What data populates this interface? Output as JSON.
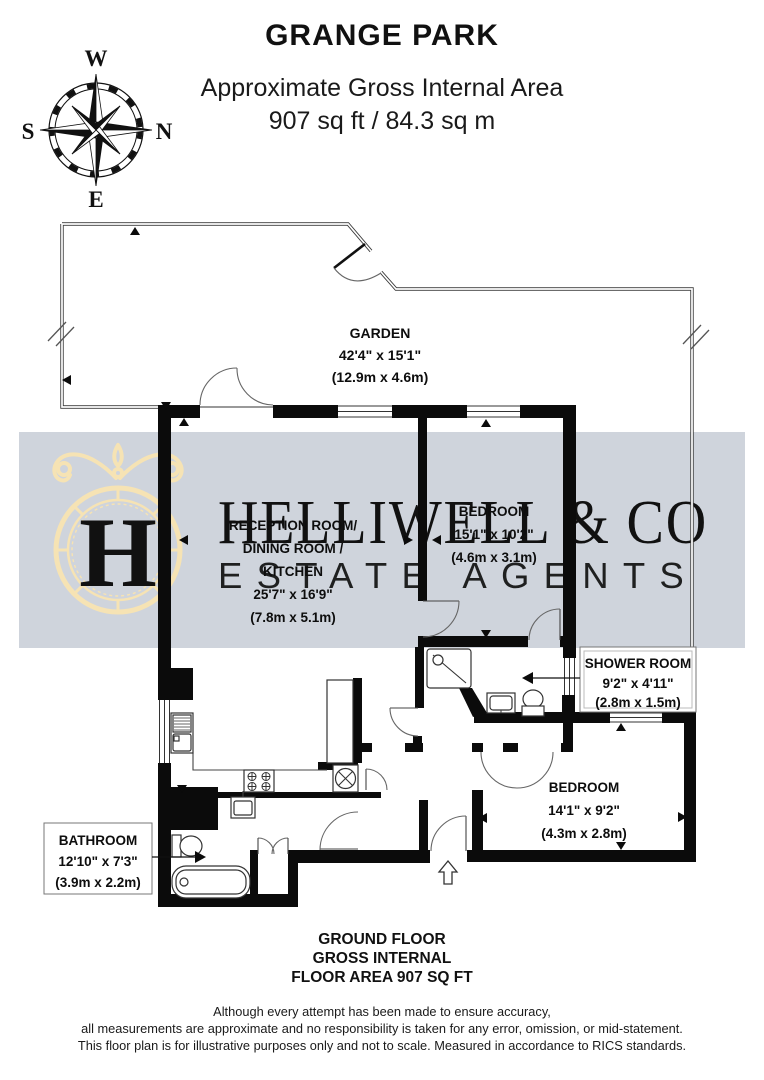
{
  "header": {
    "title": "GRANGE PARK",
    "subtitle_line1": "Approximate Gross Internal Area",
    "subtitle_line2": "907 sq ft / 84.3 sq m"
  },
  "compass": {
    "north": "N",
    "south": "S",
    "east": "E",
    "west": "W"
  },
  "watermark": {
    "monogram": "H",
    "brand": "HELLIWELL & CO",
    "tagline": "ESTATE AGENTS",
    "brand_color": "#f6e3b4",
    "band_color": "#cfd4dc",
    "tagline_color": "#ffffff"
  },
  "rooms": {
    "garden": {
      "name": "GARDEN",
      "imperial": "42'4\" x 15'1\"",
      "metric": "(12.9m x 4.6m)"
    },
    "reception": {
      "line1": "RECEPTION ROOM/",
      "line2": "DINING ROOM /",
      "line3": "KITCHEN",
      "imperial": "25'7\" x 16'9\"",
      "metric": "(7.8m x 5.1m)"
    },
    "bedroom1": {
      "name": "BEDROOM",
      "imperial": "15'1\" x 10'2\"",
      "metric": "(4.6m x 3.1m)"
    },
    "shower": {
      "name": "SHOWER ROOM",
      "imperial": "9'2\" x 4'11\"",
      "metric": "(2.8m x 1.5m)"
    },
    "bedroom2": {
      "name": "BEDROOM",
      "imperial": "14'1\" x 9'2\"",
      "metric": "(4.3m x 2.8m)"
    },
    "bathroom": {
      "name": "BATHROOM",
      "imperial": "12'10\" x 7'3\"",
      "metric": "(3.9m x 2.2m)"
    }
  },
  "footer": {
    "line1": "GROUND FLOOR",
    "line2": "GROSS INTERNAL",
    "line3": "FLOOR AREA 907 SQ FT"
  },
  "disclaimer": {
    "line1": "Although every attempt has been made to ensure accuracy,",
    "line2": "all measurements are approximate and no responsibility is taken for any error, omission, or mid-statement.",
    "line3": "This floor plan is for illustrative purposes only and not to scale. Measured in accordance to RICS standards."
  },
  "colors": {
    "wall": "#0b0b0b",
    "boundary": "#3a3a3a"
  }
}
